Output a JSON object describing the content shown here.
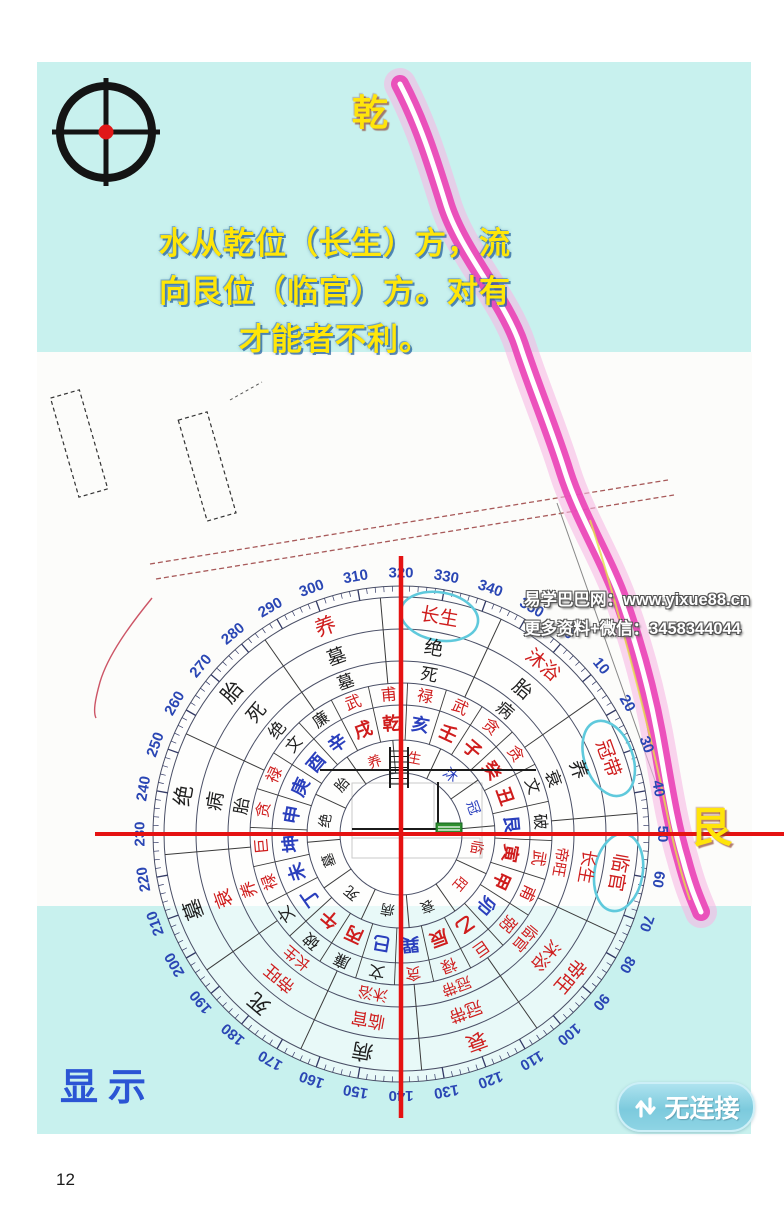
{
  "header": {
    "qian_label": "乾",
    "caption_lines": [
      "水从乾位（长生）方，流",
      "向艮位（临官）方。对有",
      "才能者不利。"
    ]
  },
  "map": {
    "gen_label": "艮"
  },
  "watermark": {
    "line1": "易学巴巴网：www.yixue88.cn",
    "line2": "更多资料+微信：3458344044"
  },
  "footer": {
    "display_label": "显示",
    "connection_label": "无连接"
  },
  "page": {
    "number": "12"
  },
  "compass": {
    "top_dial_reading": 320,
    "cross_dial_readings": {
      "up": 320,
      "right": 50,
      "down": 140,
      "left": 230
    },
    "degree_labels": [
      "0",
      "10",
      "20",
      "30",
      "40",
      "50",
      "60",
      "70",
      "80",
      "90",
      "100",
      "110",
      "120",
      "130",
      "140",
      "150",
      "160",
      "170",
      "180",
      "190",
      "200",
      "210",
      "220",
      "230",
      "240",
      "250",
      "260",
      "270",
      "280",
      "290",
      "300",
      "310",
      "320",
      "330",
      "340",
      "350"
    ],
    "colors": {
      "red": "#cf1d1d",
      "blue": "#2a3fbd",
      "black": "#1f1f1f",
      "degree": "#2a46b4"
    },
    "highlight_color": "#5fc9dc",
    "ring_stage_outer": [
      {
        "angle": 300,
        "text": "养",
        "color": "red"
      },
      {
        "angle": 330,
        "text": "长生",
        "color": "red",
        "circled": true
      },
      {
        "angle": 0,
        "text": "沐浴",
        "color": "red"
      },
      {
        "angle": 30,
        "text": "冠带",
        "color": "red",
        "circled": true
      },
      {
        "angle": 60,
        "text": "临官",
        "color": "red",
        "circled": true
      },
      {
        "angle": 90,
        "text": "帝旺",
        "color": "red"
      },
      {
        "angle": 120,
        "text": "衰",
        "color": "red"
      },
      {
        "angle": 150,
        "text": "病",
        "color": "black"
      },
      {
        "angle": 180,
        "text": "死",
        "color": "black"
      },
      {
        "angle": 210,
        "text": "墓",
        "color": "black"
      },
      {
        "angle": 240,
        "text": "绝",
        "color": "black"
      },
      {
        "angle": 270,
        "text": "胎",
        "color": "black"
      }
    ],
    "ring_stage_middle": [
      {
        "angle": 300,
        "text": "墓",
        "color": "black"
      },
      {
        "angle": 330,
        "text": "绝",
        "color": "black"
      },
      {
        "angle": 0,
        "text": "胎",
        "color": "black"
      },
      {
        "angle": 30,
        "text": "养",
        "color": "black"
      },
      {
        "angle": 60,
        "text": "长生",
        "color": "red"
      },
      {
        "angle": 90,
        "text": "沐浴",
        "color": "red"
      },
      {
        "angle": 120,
        "text": "冠带",
        "color": "red"
      },
      {
        "angle": 150,
        "text": "临官",
        "color": "red"
      },
      {
        "angle": 180,
        "text": "帝旺",
        "color": "red"
      },
      {
        "angle": 210,
        "text": "衰",
        "color": "red"
      },
      {
        "angle": 240,
        "text": "病",
        "color": "black"
      },
      {
        "angle": 270,
        "text": "死",
        "color": "black"
      }
    ],
    "ring_stage_inner_band": [
      {
        "angle": 300,
        "text": "墓",
        "color": "black"
      },
      {
        "angle": 330,
        "text": "死",
        "color": "black"
      },
      {
        "angle": 0,
        "text": "病",
        "color": "black"
      },
      {
        "angle": 30,
        "text": "衰",
        "color": "black"
      },
      {
        "angle": 60,
        "text": "帝旺",
        "color": "red"
      },
      {
        "angle": 90,
        "text": "临官",
        "color": "red"
      },
      {
        "angle": 120,
        "text": "冠带",
        "color": "red"
      },
      {
        "angle": 150,
        "text": "沐浴",
        "color": "red"
      },
      {
        "angle": 180,
        "text": "长生",
        "color": "red"
      },
      {
        "angle": 210,
        "text": "养",
        "color": "red"
      },
      {
        "angle": 240,
        "text": "胎",
        "color": "black"
      },
      {
        "angle": 270,
        "text": "绝",
        "color": "black"
      }
    ],
    "ring_nine_stars": [
      {
        "angle": 0,
        "text": "贪",
        "color": "red"
      },
      {
        "angle": 15,
        "text": "贪",
        "color": "red"
      },
      {
        "angle": 30,
        "text": "文",
        "color": "black"
      },
      {
        "angle": 45,
        "text": "破",
        "color": "black"
      },
      {
        "angle": 60,
        "text": "武",
        "color": "red"
      },
      {
        "angle": 75,
        "text": "甫",
        "color": "red"
      },
      {
        "angle": 90,
        "text": "弼",
        "color": "red"
      },
      {
        "angle": 105,
        "text": "巨",
        "color": "red"
      },
      {
        "angle": 120,
        "text": "禄",
        "color": "red"
      },
      {
        "angle": 135,
        "text": "贪",
        "color": "red"
      },
      {
        "angle": 150,
        "text": "文",
        "color": "black"
      },
      {
        "angle": 165,
        "text": "廉",
        "color": "black"
      },
      {
        "angle": 180,
        "text": "破",
        "color": "black"
      },
      {
        "angle": 195,
        "text": "文",
        "color": "black"
      },
      {
        "angle": 210,
        "text": "禄",
        "color": "red"
      },
      {
        "angle": 225,
        "text": "巨",
        "color": "red"
      },
      {
        "angle": 240,
        "text": "贪",
        "color": "red"
      },
      {
        "angle": 255,
        "text": "禄",
        "color": "red"
      },
      {
        "angle": 270,
        "text": "文",
        "color": "black"
      },
      {
        "angle": 285,
        "text": "廉",
        "color": "black"
      },
      {
        "angle": 300,
        "text": "武",
        "color": "red"
      },
      {
        "angle": 315,
        "text": "甫",
        "color": "red"
      },
      {
        "angle": 330,
        "text": "禄",
        "color": "red"
      },
      {
        "angle": 345,
        "text": "武",
        "color": "red"
      }
    ],
    "ring_mountains": [
      {
        "angle": 0,
        "text": "子",
        "color": "red"
      },
      {
        "angle": 15,
        "text": "癸",
        "color": "red"
      },
      {
        "angle": 30,
        "text": "丑",
        "color": "red"
      },
      {
        "angle": 45,
        "text": "艮",
        "color": "blue"
      },
      {
        "angle": 60,
        "text": "寅",
        "color": "red"
      },
      {
        "angle": 75,
        "text": "甲",
        "color": "red"
      },
      {
        "angle": 90,
        "text": "卯",
        "color": "blue"
      },
      {
        "angle": 105,
        "text": "乙",
        "color": "red"
      },
      {
        "angle": 120,
        "text": "辰",
        "color": "red"
      },
      {
        "angle": 135,
        "text": "巽",
        "color": "blue"
      },
      {
        "angle": 150,
        "text": "巳",
        "color": "blue"
      },
      {
        "angle": 165,
        "text": "丙",
        "color": "red"
      },
      {
        "angle": 180,
        "text": "午",
        "color": "red"
      },
      {
        "angle": 195,
        "text": "丁",
        "color": "blue"
      },
      {
        "angle": 210,
        "text": "未",
        "color": "blue"
      },
      {
        "angle": 225,
        "text": "坤",
        "color": "blue"
      },
      {
        "angle": 240,
        "text": "申",
        "color": "blue"
      },
      {
        "angle": 255,
        "text": "庚",
        "color": "blue"
      },
      {
        "angle": 270,
        "text": "酉",
        "color": "blue"
      },
      {
        "angle": 285,
        "text": "辛",
        "color": "blue"
      },
      {
        "angle": 300,
        "text": "戌",
        "color": "red"
      },
      {
        "angle": 315,
        "text": "乾",
        "color": "red"
      },
      {
        "angle": 330,
        "text": "亥",
        "color": "blue"
      },
      {
        "angle": 345,
        "text": "壬",
        "color": "red"
      }
    ],
    "ring_center_stages": [
      {
        "angle": 300,
        "text": "养",
        "color": "red"
      },
      {
        "angle": 330,
        "text": "生",
        "color": "red"
      },
      {
        "angle": 0,
        "text": "沐",
        "color": "blue"
      },
      {
        "angle": 30,
        "text": "冠",
        "color": "blue"
      },
      {
        "angle": 60,
        "text": "临",
        "color": "red"
      },
      {
        "angle": 90,
        "text": "旺",
        "color": "red"
      },
      {
        "angle": 120,
        "text": "衰",
        "color": "black"
      },
      {
        "angle": 150,
        "text": "病",
        "color": "black"
      },
      {
        "angle": 180,
        "text": "死",
        "color": "black"
      },
      {
        "angle": 210,
        "text": "墓",
        "color": "black"
      },
      {
        "angle": 240,
        "text": "绝",
        "color": "black"
      },
      {
        "angle": 270,
        "text": "胎",
        "color": "black"
      }
    ]
  }
}
